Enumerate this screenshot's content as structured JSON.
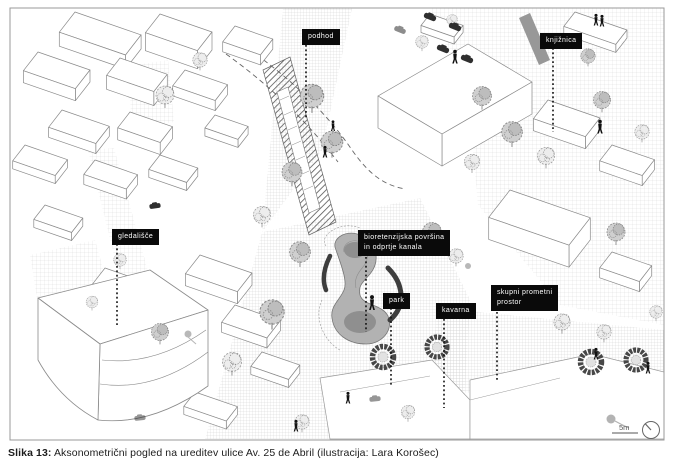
{
  "figure": {
    "caption_label": "Slika 13:",
    "caption_text": " Aksonometrični pogled na ureditev ulice Av. 25 de Abril (ilustracija: Lara Korošec)"
  },
  "labels": {
    "podhod": "podhod",
    "knjiznica": "knjižnica",
    "gledalisce": "gledališče",
    "bioretenzijska_line1": "bioretenzijska površina",
    "bioretenzijska_line2": "in odprtje kanala",
    "park": "park",
    "kavarna": "kavarna",
    "skupni_line1": "skupni prometni",
    "skupni_line2": "prostor"
  },
  "scale": {
    "label": "5m"
  },
  "colors": {
    "label_bg": "#0a0a0a",
    "label_text": "#ffffff",
    "linework": "#8a8a8a",
    "dark_accent": "#3d3d3d",
    "pond_fill": "#b2b2b2"
  }
}
